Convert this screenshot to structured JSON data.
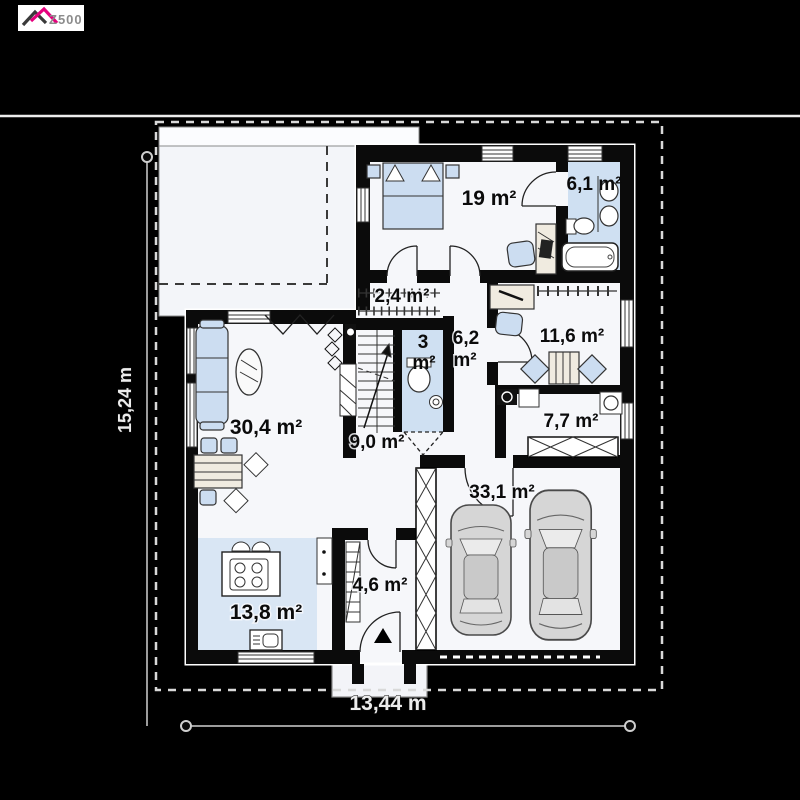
{
  "brand": {
    "name": "Z500"
  },
  "dimensions": {
    "height_label": "15,24 m",
    "width_label": "13,44 m"
  },
  "rooms": [
    {
      "name": "bedroom",
      "area_label": "19 m²"
    },
    {
      "name": "bathroom",
      "area_label": "6,1 m²"
    },
    {
      "name": "wardrobe",
      "area_label": "2,4 m²"
    },
    {
      "name": "wc",
      "area_value": "3",
      "area_unit": "m²"
    },
    {
      "name": "hallway",
      "area_value": "6,2",
      "area_unit": "m²"
    },
    {
      "name": "office",
      "area_label": "11,6 m²"
    },
    {
      "name": "living-room",
      "area_label": "30,4 m²"
    },
    {
      "name": "stair-hall",
      "area_label": "9,0 m²"
    },
    {
      "name": "utility-room",
      "area_label": "7,7 m²"
    },
    {
      "name": "garage",
      "area_label": "33,1 m²"
    },
    {
      "name": "vestibule",
      "area_label": "4,6 m²"
    },
    {
      "name": "kitchen",
      "area_label": "13,8 m²"
    }
  ],
  "colors": {
    "background": "#000000",
    "floor": "#f6f7fa",
    "accent_floor": "#cfe0f2",
    "furniture": "#ccddf1",
    "boundary": "#d9d9d9",
    "brand_pink": "#e5007d"
  }
}
